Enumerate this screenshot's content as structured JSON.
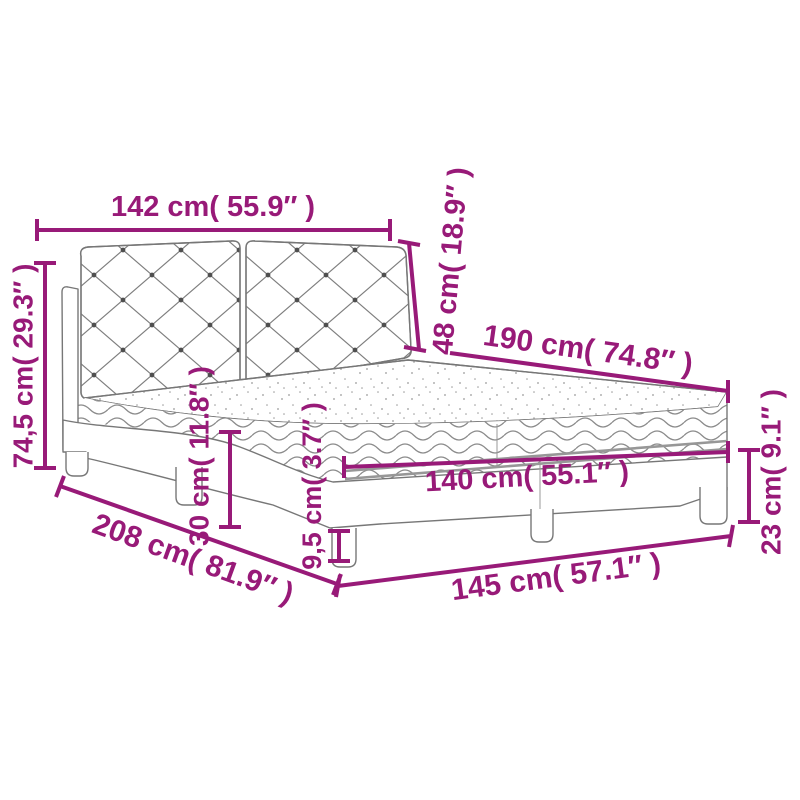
{
  "diagram": {
    "type": "product-dimension-diagram",
    "subject": "bed with tufted headboard, mattress and curved frame",
    "accent_color": "#981a78",
    "artwork_color": "#777777",
    "background_color": "#ffffff",
    "labels": {
      "headboard_width": "142 cm( 55.9″ )",
      "headboard_height": "48 cm( 18.9″ )",
      "mattress_length": "190 cm( 74.8″ )",
      "total_height": "74,5 cm( 29.3″ )",
      "frame_height": "30 cm( 11.8″ )",
      "mattress_width": "140 cm( 55.1″ )",
      "slat_clearance": "9,5 cm( 3.7″ )",
      "total_length": "208 cm( 81.9″ )",
      "total_width": "145 cm( 57.1″ )",
      "leg_height": "23 cm( 9.1″ )"
    },
    "measurements": [
      {
        "part": "headboard width",
        "cm": "142",
        "inch": "55.9"
      },
      {
        "part": "headboard height",
        "cm": "48",
        "inch": "18.9"
      },
      {
        "part": "mattress length",
        "cm": "190",
        "inch": "74.8"
      },
      {
        "part": "total height",
        "cm": "74,5",
        "inch": "29.3"
      },
      {
        "part": "frame height",
        "cm": "30",
        "inch": "11.8"
      },
      {
        "part": "mattress width",
        "cm": "140",
        "inch": "55.1"
      },
      {
        "part": "base clearance",
        "cm": "9,5",
        "inch": "3.7"
      },
      {
        "part": "total length",
        "cm": "208",
        "inch": "81.9"
      },
      {
        "part": "total width",
        "cm": "145",
        "inch": "57.1"
      },
      {
        "part": "leg height",
        "cm": "23",
        "inch": "9.1"
      }
    ]
  }
}
